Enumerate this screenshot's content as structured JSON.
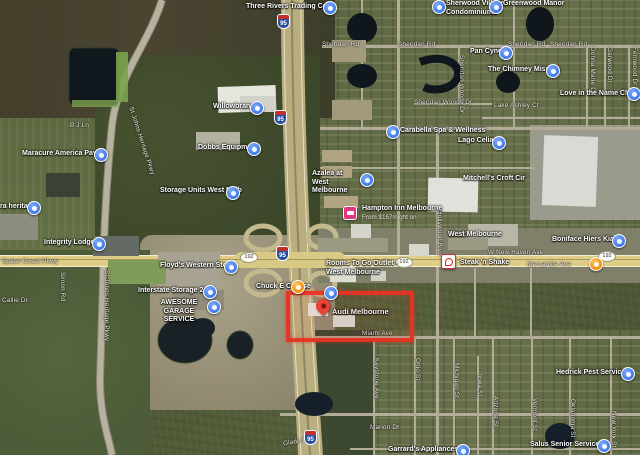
{
  "map_type": "satellite",
  "highlight": {
    "label": "Audi Melbourne",
    "color": "#e83223"
  },
  "shields": {
    "interstate": "95",
    "route": "192"
  },
  "hotel": {
    "name": "Hampton Inn Melbourne",
    "price": "From $157/night on"
  },
  "pois": [
    {
      "name": "Three Rivers Trading Co"
    },
    {
      "name": "Sherwood Village Condominiums"
    },
    {
      "name": "Greenwood Manor"
    },
    {
      "name": "Pan Cync"
    },
    {
      "name": "The Chimney Mission"
    },
    {
      "name": "Love in the Name Christ"
    },
    {
      "name": "Willowbranch"
    },
    {
      "name": "Carabella Spa & Wellness"
    },
    {
      "name": "Lago Celia"
    },
    {
      "name": "Dobbs Equipment"
    },
    {
      "name": "Maracure America Pavers"
    },
    {
      "name": "Azalea at West Melbourne"
    },
    {
      "name": "Storage Units West Melb"
    },
    {
      "name": "ra heritage"
    },
    {
      "name": "Floyd's Western Store"
    },
    {
      "name": "Interstate Storage 2134"
    },
    {
      "name": "AWESOME GARAGE SERVICE"
    },
    {
      "name": "Integrity Lodge"
    },
    {
      "name": "Boniface Hiers Kia"
    },
    {
      "name": "Hedrick Pest Service"
    },
    {
      "name": "Salus Senior Services"
    },
    {
      "name": "Garrard's Appliances"
    },
    {
      "name": "Chuck E Cheese"
    },
    {
      "name": "Steak 'n Shake"
    },
    {
      "name": "Mitchell's Croft Cir"
    },
    {
      "name": "West Melbourne"
    },
    {
      "name": "Rooms To Go Outlet - West Melbourne"
    }
  ],
  "roads": [
    "Sheridan Rd",
    "Space Coast Pkwy",
    "W New Haven Ave",
    "St Johns Heritage Pkwy",
    "Miami Ave",
    "Marion Dr",
    "Glade Rd",
    "B J Ln",
    "Callie Dr",
    "Simon Rd",
    "Keystone Ave",
    "Ohio St",
    "Michigan St",
    "Iowa St",
    "Arizona St",
    "Vermont St",
    "Oklahoma St",
    "New York St",
    "Sheridan Woods Dr",
    "Lake Ashley Ct",
    "Donna Marie Dr",
    "Garwood Dr",
    "Fernwood Dr",
    "Hollywood Blvd",
    "Mercantile Ave"
  ]
}
